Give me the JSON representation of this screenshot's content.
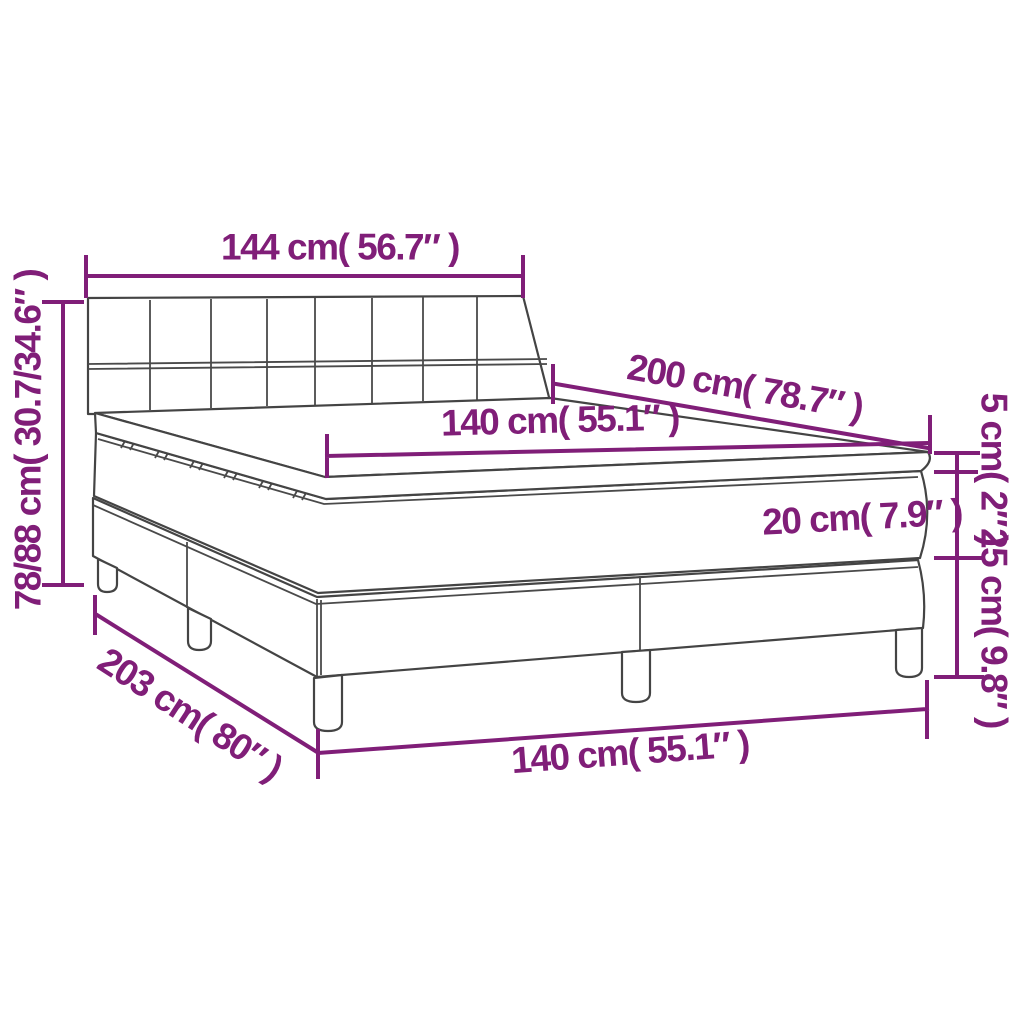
{
  "diagram": {
    "title": "box-spring bed dimension diagram",
    "colors": {
      "dimension_color": "#801e78",
      "outline_color": "#444444",
      "background": "#ffffff"
    },
    "labels": {
      "headboard_width": "144 cm( 56.7″ )",
      "total_height": "78/88 cm( 30.7/34.6″ )",
      "mattress_length": "200 cm( 78.7″ )",
      "mattress_width": "140 cm( 55.1″ )",
      "topper_thickness": "5 cm( 2″ )",
      "mattress_thickness": "20 cm( 7.9″ )",
      "base_height": "25 cm( 9.8″ )",
      "bed_width": "140 cm( 55.1″ )",
      "bed_length": "203 cm( 80″ )"
    }
  }
}
